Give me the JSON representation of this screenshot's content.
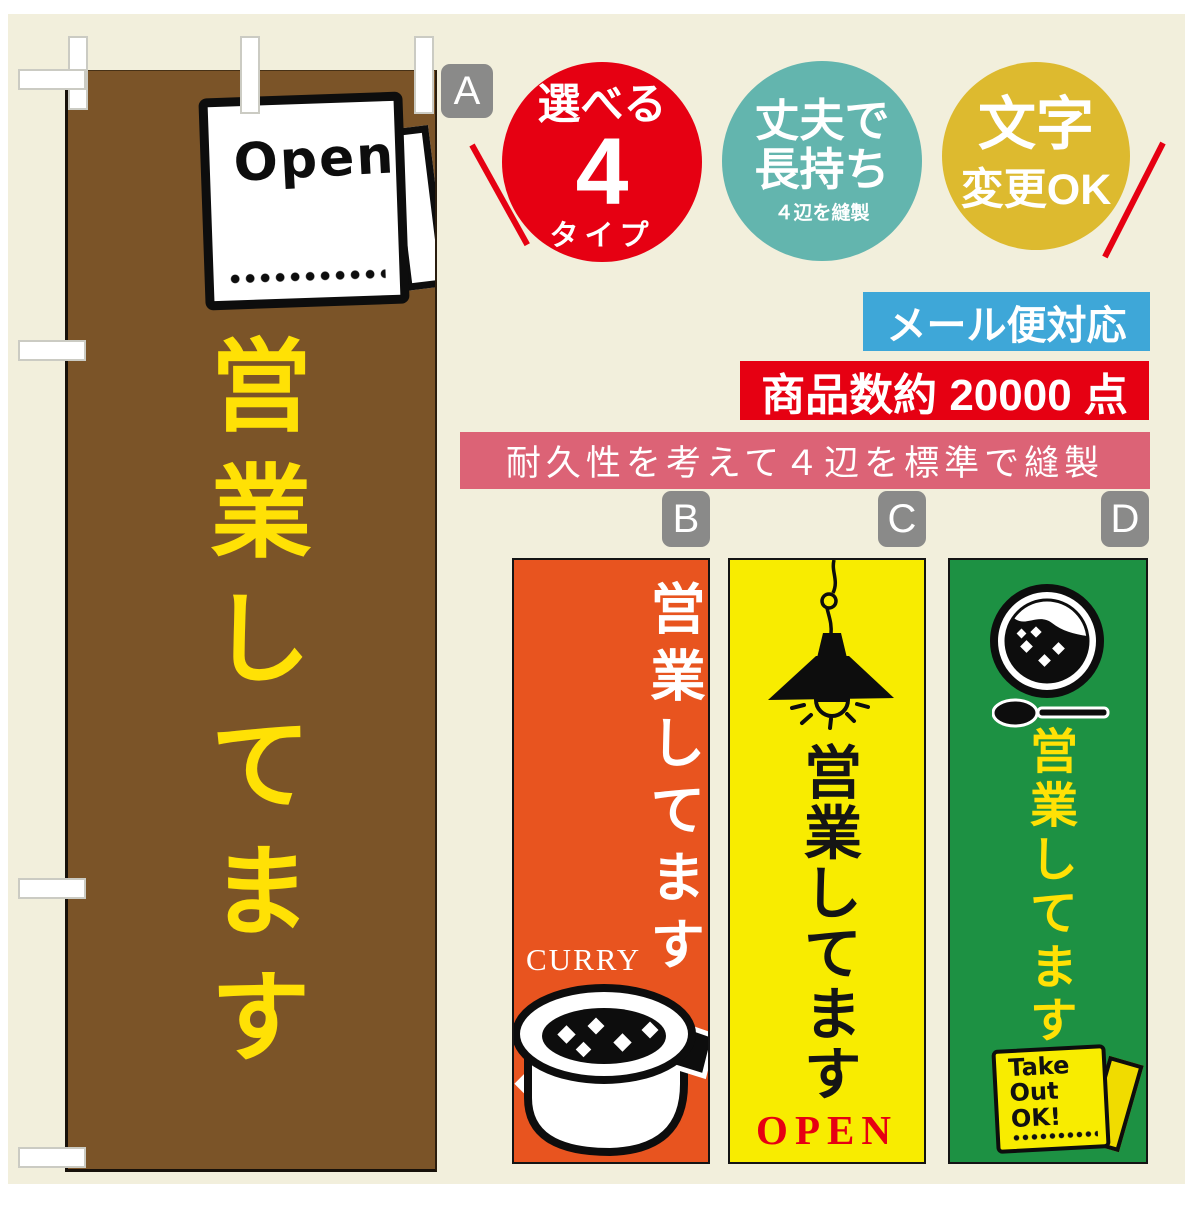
{
  "palette": {
    "background": "#f2efdc",
    "banner_a_bg": "#7b5428",
    "banner_a_text": "#ffe105",
    "banner_b_bg": "#e8541f",
    "banner_c_bg": "#f8ec00",
    "banner_d_bg": "#1d9143",
    "badge_red": "#e60012",
    "badge_teal": "#63b5ae",
    "badge_gold": "#ddba2f",
    "bar_blue": "#3ea7d8",
    "bar_red": "#e60012",
    "bar_pink": "#dc6376",
    "label_gray": "#8a8a89"
  },
  "banner_a": {
    "label": "A",
    "vertical_text": "営業してます",
    "sign_text": "Open"
  },
  "badges": {
    "types": {
      "top": "選べる",
      "number": "4",
      "bottom": "タイプ"
    },
    "durable": {
      "line1": "丈夫で",
      "line2": "長持ち",
      "sub": "４辺を縫製"
    },
    "custom": {
      "line1": "文字",
      "line2": "変更OK"
    }
  },
  "info_bars": {
    "mail": "メール便対応",
    "count": "商品数約 20000 点",
    "sewing": "耐久性を考えて４辺を標準で縫製"
  },
  "banner_b": {
    "label": "B",
    "vertical_text": "営業してます",
    "caption": "CURRY"
  },
  "banner_c": {
    "label": "C",
    "vertical_text": "営業してます",
    "caption": "OPEN"
  },
  "banner_d": {
    "label": "D",
    "vertical_text": "営業してます",
    "sign_lines": [
      "Take",
      "Out",
      "OK!"
    ]
  }
}
